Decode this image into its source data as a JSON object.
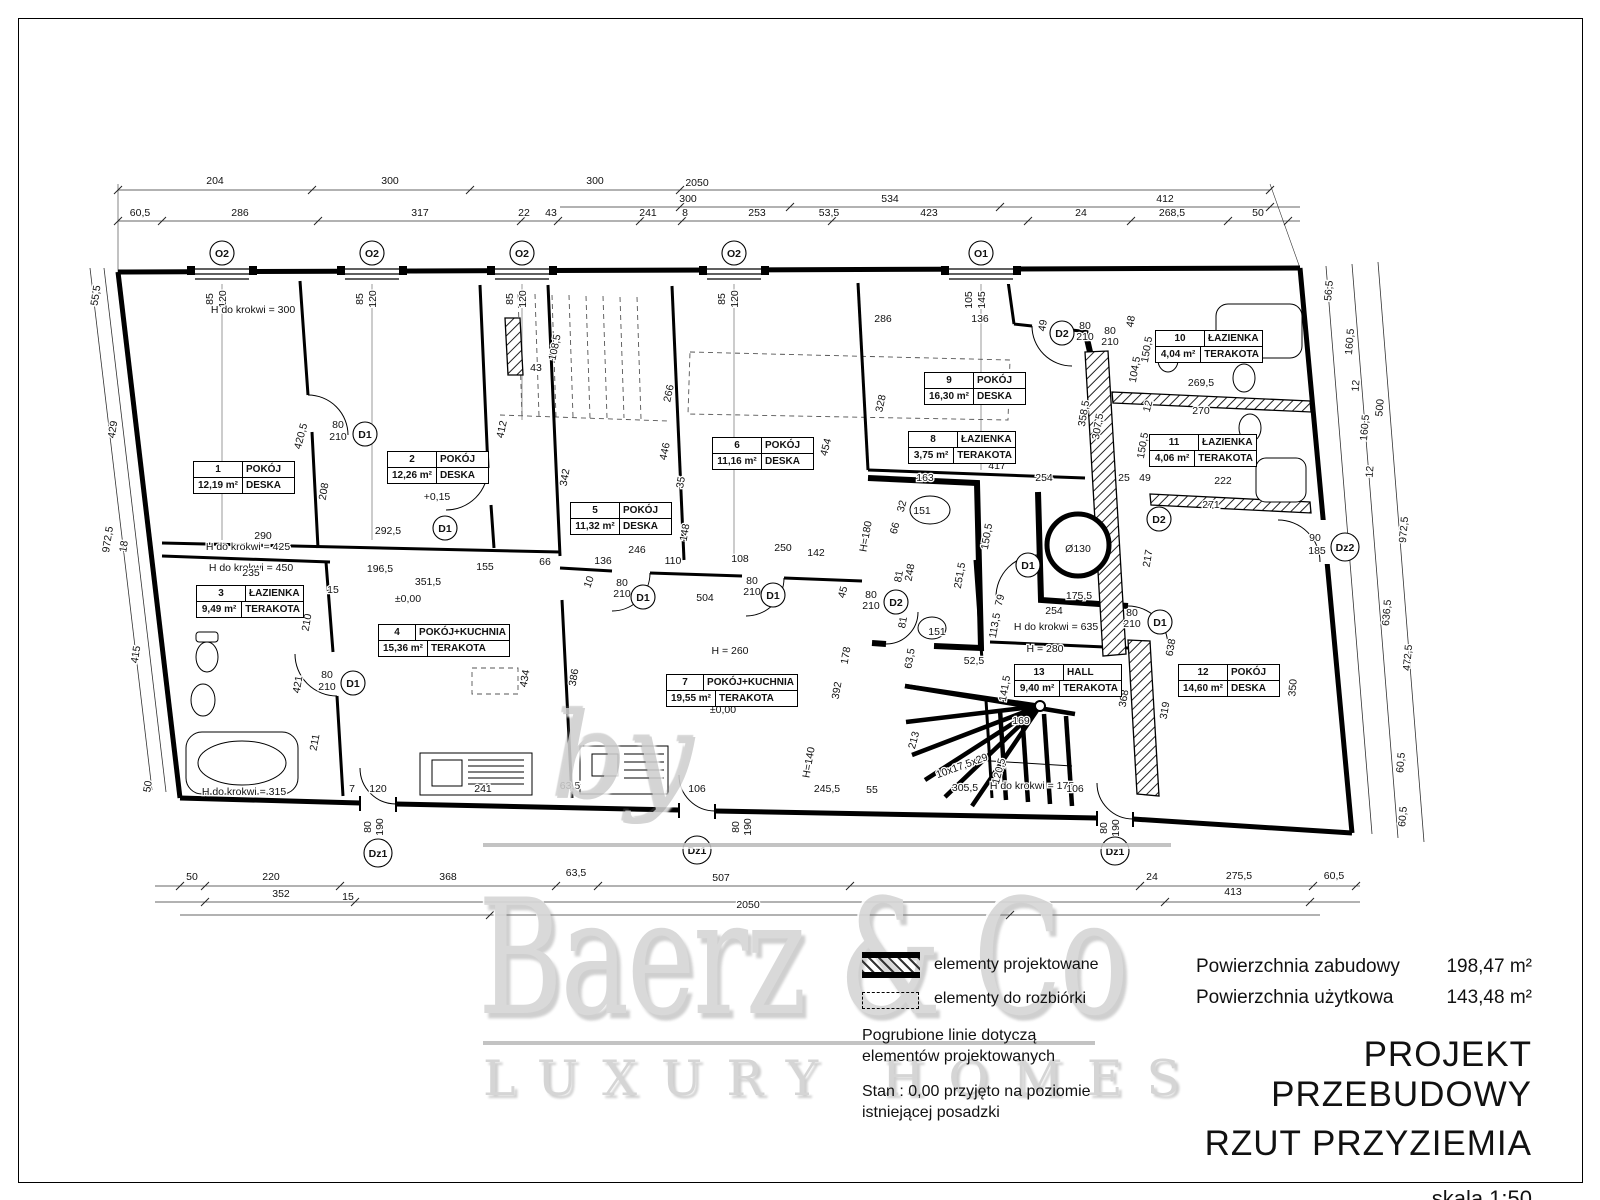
{
  "watermark": {
    "by": "by",
    "name": "Baerz & Co",
    "tagline": "LUXURY HOMES"
  },
  "legend": {
    "item1": "elementy projektowane",
    "item2": "elementy do rozbiórki",
    "note1_line1": "Pogrubione linie dotyczą",
    "note1_line2": "elementów projektowanych",
    "note2_line1": "Stan : 0,00 przyjęto na poziomie",
    "note2_line2": "istniejącej posadzki"
  },
  "title_block": {
    "area_built_label": "Powierzchnia zabudowy",
    "area_built_value": "198,47 m²",
    "area_usable_label": "Powierzchnia użytkowa",
    "area_usable_value": "143,48 m²",
    "project_title_line1": "PROJEKT PRZEBUDOWY",
    "project_title_line2": "RZUT PRZYZIEMIA",
    "scale": "skala 1:50"
  },
  "rooms": [
    {
      "num": "1",
      "name": "POKÓJ",
      "area": "12,19 m²",
      "floor": "DESKA",
      "x": 193,
      "y": 461,
      "w": 100
    },
    {
      "num": "2",
      "name": "POKÓJ",
      "area": "12,26 m²",
      "floor": "DESKA",
      "x": 387,
      "y": 451,
      "w": 100
    },
    {
      "num": "3",
      "name": "ŁAZIENKA",
      "area": "9,49 m²",
      "floor": "TERAKOTA",
      "x": 196,
      "y": 585,
      "w": 106
    },
    {
      "num": "4",
      "name": "POKÓJ+KUCHNIA",
      "area": "15,36 m²",
      "floor": "TERAKOTA",
      "x": 378,
      "y": 624,
      "w": 130
    },
    {
      "num": "5",
      "name": "POKÓJ",
      "area": "11,32 m²",
      "floor": "DESKA",
      "x": 570,
      "y": 502,
      "w": 100
    },
    {
      "num": "6",
      "name": "POKÓJ",
      "area": "11,16 m²",
      "floor": "DESKA",
      "x": 712,
      "y": 437,
      "w": 100
    },
    {
      "num": "7",
      "name": "POKÓJ+KUCHNIA",
      "area": "19,55 m²",
      "floor": "TERAKOTA",
      "x": 666,
      "y": 674,
      "w": 130
    },
    {
      "num": "8",
      "name": "ŁAZIENKA",
      "area": "3,75 m²",
      "floor": "TERAKOTA",
      "x": 908,
      "y": 431,
      "w": 106
    },
    {
      "num": "9",
      "name": "POKÓJ",
      "area": "16,30 m²",
      "floor": "DESKA",
      "x": 924,
      "y": 372,
      "w": 100
    },
    {
      "num": "10",
      "name": "ŁAZIENKA",
      "area": "4,04 m²",
      "floor": "TERAKOTA",
      "x": 1155,
      "y": 330,
      "w": 106
    },
    {
      "num": "11",
      "name": "ŁAZIENKA",
      "area": "4,06 m²",
      "floor": "TERAKOTA",
      "x": 1149,
      "y": 434,
      "w": 106
    },
    {
      "num": "12",
      "name": "POKÓJ",
      "area": "14,60 m²",
      "floor": "DESKA",
      "x": 1178,
      "y": 664,
      "w": 100
    },
    {
      "num": "13",
      "name": "HALL",
      "area": "9,40 m²",
      "floor": "TERAKOTA",
      "x": 1014,
      "y": 664,
      "w": 106
    }
  ],
  "plan": {
    "markers": [
      [
        "O2",
        222,
        253
      ],
      [
        "O2",
        372,
        253
      ],
      [
        "O2",
        522,
        253
      ],
      [
        "O2",
        734,
        253
      ],
      [
        "O1",
        981,
        253
      ],
      [
        "D1",
        365,
        434
      ],
      [
        "D1",
        445,
        528
      ],
      [
        "D1",
        353,
        683
      ],
      [
        "D1",
        643,
        597
      ],
      [
        "D1",
        773,
        595
      ],
      [
        "D1",
        1028,
        565
      ],
      [
        "D1",
        1160,
        622
      ],
      [
        "D2",
        1062,
        333
      ],
      [
        "D2",
        896,
        602
      ],
      [
        "D2",
        1159,
        519
      ],
      [
        "Dz1",
        378,
        853
      ],
      [
        "Dz1",
        697,
        850
      ],
      [
        "Dz1",
        1115,
        851
      ],
      [
        "Dz2",
        1345,
        547
      ]
    ],
    "dim_labels": [
      [
        "204",
        215,
        184
      ],
      [
        "300",
        390,
        184
      ],
      [
        "300",
        595,
        184
      ],
      [
        "2050",
        697,
        186
      ],
      [
        "300",
        688,
        202
      ],
      [
        "534",
        890,
        202
      ],
      [
        "412",
        1165,
        202
      ],
      [
        "60,5",
        140,
        216
      ],
      [
        "286",
        240,
        216
      ],
      [
        "317",
        420,
        216
      ],
      [
        "22",
        524,
        216
      ],
      [
        "43",
        551,
        216
      ],
      [
        "241",
        648,
        216
      ],
      [
        "8",
        685,
        216
      ],
      [
        "253",
        757,
        216
      ],
      [
        "53,5",
        829,
        216
      ],
      [
        "423",
        929,
        216
      ],
      [
        "24",
        1081,
        216
      ],
      [
        "268,5",
        1172,
        216
      ],
      [
        "50",
        1258,
        216
      ],
      [
        "85",
        213,
        299,
        -90,
        9.5
      ],
      [
        "120",
        226,
        299,
        -90,
        9.5
      ],
      [
        "85",
        363,
        299,
        -90,
        9.5
      ],
      [
        "120",
        376,
        299,
        -90,
        9.5
      ],
      [
        "85",
        513,
        299,
        -90,
        9.5
      ],
      [
        "120",
        526,
        299,
        -90,
        9.5
      ],
      [
        "85",
        725,
        299,
        -90,
        9.5
      ],
      [
        "120",
        738,
        299,
        -90,
        9.5
      ],
      [
        "105",
        972,
        300,
        -90,
        9.5
      ],
      [
        "145",
        985,
        300,
        -90,
        9.5
      ],
      [
        "55,5",
        99,
        296,
        -81
      ],
      [
        "429",
        116,
        430,
        -81
      ],
      [
        "972,5",
        111,
        540,
        -81
      ],
      [
        "18",
        127,
        547,
        -81
      ],
      [
        "415",
        139,
        655,
        -81
      ],
      [
        "50",
        151,
        787,
        -81
      ],
      [
        "56,5",
        1332,
        291,
        -85
      ],
      [
        "160,5",
        1353,
        342,
        -85
      ],
      [
        "12",
        1359,
        386,
        -85
      ],
      [
        "500",
        1383,
        408,
        -85
      ],
      [
        "160,5",
        1368,
        428,
        -85
      ],
      [
        "12",
        1373,
        472,
        -85
      ],
      [
        "972,5",
        1407,
        530,
        -85
      ],
      [
        "636,5",
        1390,
        613,
        -85
      ],
      [
        "472,5",
        1411,
        658,
        -85
      ],
      [
        "350",
        1296,
        688,
        -85
      ],
      [
        "60,5",
        1404,
        763,
        -85
      ],
      [
        "60,5",
        1406,
        817,
        -85
      ],
      [
        "90",
        1315,
        541
      ],
      [
        "185",
        1317,
        554
      ],
      [
        "H do krokwi = 300",
        253,
        313,
        0,
        10
      ],
      [
        "H do krokwi = 425",
        248,
        550,
        0,
        10
      ],
      [
        "H do krokwi = 450",
        251,
        571,
        0,
        10
      ],
      [
        "H do krokwi = 315",
        244,
        795,
        0,
        10
      ],
      [
        "H do krokwi = 635",
        1056,
        630,
        0,
        10
      ],
      [
        "H do krokwi = 175",
        1032,
        789,
        0,
        10
      ],
      [
        "H = 260",
        730,
        654,
        0,
        10
      ],
      [
        "H = 280",
        1045,
        652,
        0,
        10
      ],
      [
        "±0,00",
        408,
        602
      ],
      [
        "±0,00",
        723,
        713
      ],
      [
        "+0,15",
        437,
        500
      ],
      [
        "Ø130",
        1078,
        552,
        0,
        11
      ],
      [
        "420,5",
        304,
        437,
        -75
      ],
      [
        "80",
        338,
        428
      ],
      [
        "210",
        338,
        440
      ],
      [
        "208",
        327,
        492,
        -80
      ],
      [
        "290",
        263,
        539
      ],
      [
        "292,5",
        388,
        534
      ],
      [
        "235",
        251,
        576
      ],
      [
        "196,5",
        380,
        572
      ],
      [
        "155",
        485,
        570
      ],
      [
        "351,5",
        428,
        585
      ],
      [
        "15",
        333,
        593
      ],
      [
        "412",
        505,
        430,
        -78
      ],
      [
        "210",
        310,
        623,
        -80
      ],
      [
        "421",
        301,
        685,
        -80
      ],
      [
        "80",
        327,
        678
      ],
      [
        "210",
        327,
        690
      ],
      [
        "434",
        528,
        679,
        -80
      ],
      [
        "211",
        318,
        743,
        -80
      ],
      [
        "108,5",
        558,
        348,
        -78
      ],
      [
        "43",
        536,
        371
      ],
      [
        "266",
        672,
        394,
        -78
      ],
      [
        "446",
        668,
        452,
        -78
      ],
      [
        "35",
        684,
        483,
        -80
      ],
      [
        "148",
        688,
        533,
        -80
      ],
      [
        "342",
        568,
        478,
        -80
      ],
      [
        "246",
        637,
        553
      ],
      [
        "136",
        603,
        564
      ],
      [
        "110",
        673,
        564
      ],
      [
        "108",
        740,
        562
      ],
      [
        "250",
        783,
        551
      ],
      [
        "142",
        816,
        556
      ],
      [
        "66",
        545,
        565
      ],
      [
        "10",
        592,
        583,
        -70
      ],
      [
        "454",
        829,
        448,
        -75
      ],
      [
        "80",
        622,
        586
      ],
      [
        "210",
        622,
        597
      ],
      [
        "80",
        752,
        584
      ],
      [
        "210",
        752,
        595
      ],
      [
        "504",
        705,
        601
      ],
      [
        "386",
        577,
        678,
        -80
      ],
      [
        "178",
        849,
        656,
        -80
      ],
      [
        "392",
        840,
        691,
        -80
      ],
      [
        "H=140",
        812,
        763,
        -80,
        10
      ],
      [
        "213",
        917,
        741,
        -75
      ],
      [
        "10x17,5x29",
        963,
        769,
        -20,
        9.5
      ],
      [
        "120,5",
        1002,
        772,
        -75
      ],
      [
        "305,5",
        965,
        791
      ],
      [
        "106",
        697,
        792
      ],
      [
        "245,5",
        827,
        792
      ],
      [
        "55",
        872,
        793
      ],
      [
        "106",
        1075,
        792
      ],
      [
        "7",
        352,
        792
      ],
      [
        "120",
        378,
        792
      ],
      [
        "241",
        483,
        792
      ],
      [
        "63,5",
        570,
        789
      ],
      [
        "80",
        371,
        827,
        -90
      ],
      [
        "190",
        383,
        827,
        -90
      ],
      [
        "80",
        739,
        827,
        -90
      ],
      [
        "190",
        751,
        827,
        -90
      ],
      [
        "80",
        1107,
        828,
        -90
      ],
      [
        "190",
        1119,
        828,
        -90
      ],
      [
        "286",
        883,
        322
      ],
      [
        "136",
        980,
        322
      ],
      [
        "49",
        1046,
        326,
        -80
      ],
      [
        "80",
        1085,
        329
      ],
      [
        "210",
        1085,
        340
      ],
      [
        "48",
        1134,
        322,
        -80
      ],
      [
        "80",
        1110,
        334
      ],
      [
        "210",
        1110,
        345
      ],
      [
        "104,5",
        1138,
        370,
        -80
      ],
      [
        "150,5",
        1150,
        350,
        -80
      ],
      [
        "328",
        884,
        404,
        -78
      ],
      [
        "358,5",
        1087,
        414,
        -80
      ],
      [
        "307,5",
        1101,
        427,
        -80
      ],
      [
        "269,5",
        1201,
        386
      ],
      [
        "12",
        1151,
        407,
        -75
      ],
      [
        "270",
        1201,
        414
      ],
      [
        "150,5",
        1146,
        446,
        -80
      ],
      [
        "417",
        997,
        469
      ],
      [
        "163",
        925,
        481
      ],
      [
        "254",
        1044,
        481
      ],
      [
        "25",
        1124,
        481
      ],
      [
        "49",
        1145,
        481
      ],
      [
        "222",
        1223,
        484
      ],
      [
        "271",
        1211,
        508
      ],
      [
        "217",
        1151,
        559,
        -80
      ],
      [
        "32",
        905,
        507,
        -75
      ],
      [
        "151",
        922,
        514
      ],
      [
        "66",
        898,
        529,
        -75
      ],
      [
        "H=180",
        869,
        537,
        -80,
        10
      ],
      [
        "248",
        913,
        573,
        -80
      ],
      [
        "81",
        902,
        577,
        -80
      ],
      [
        "251,5",
        963,
        576,
        -80
      ],
      [
        "150,5",
        990,
        537,
        -80
      ],
      [
        "45",
        846,
        593,
        -75
      ],
      [
        "80",
        871,
        598
      ],
      [
        "210",
        871,
        609
      ],
      [
        "81",
        906,
        623,
        -80
      ],
      [
        "151",
        937,
        635
      ],
      [
        "63,5",
        913,
        659,
        -80
      ],
      [
        "52,5",
        974,
        664
      ],
      [
        "79",
        1003,
        601,
        -75
      ],
      [
        "113,5",
        998,
        626,
        -80
      ],
      [
        "175,5",
        1079,
        599
      ],
      [
        "254",
        1054,
        614
      ],
      [
        "80",
        1132,
        616
      ],
      [
        "210",
        1132,
        627
      ],
      [
        "638",
        1174,
        648,
        -80
      ],
      [
        "141,5",
        1008,
        689,
        -80
      ],
      [
        "368",
        1127,
        699,
        -80
      ],
      [
        "319",
        1168,
        711,
        -80
      ],
      [
        "169",
        1021,
        724
      ],
      [
        "50",
        192,
        880
      ],
      [
        "220",
        271,
        880
      ],
      [
        "368",
        448,
        880
      ],
      [
        "63,5",
        576,
        876
      ],
      [
        "507",
        721,
        881
      ],
      [
        "24",
        1152,
        880
      ],
      [
        "275,5",
        1239,
        879
      ],
      [
        "60,5",
        1334,
        879
      ],
      [
        "352",
        281,
        897
      ],
      [
        "15",
        348,
        900
      ],
      [
        "413",
        1233,
        895
      ],
      [
        "2050",
        748,
        908
      ]
    ]
  }
}
